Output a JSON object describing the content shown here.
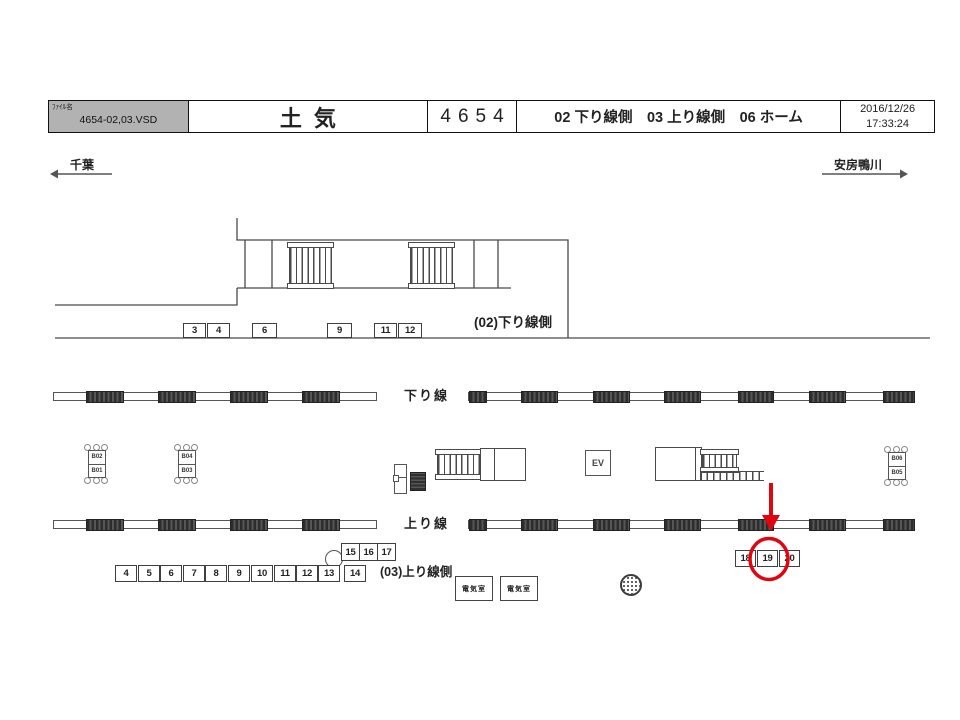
{
  "header": {
    "file_label": "ﾌｧｲﾙ名",
    "file_name": "4654-02,03.VSD",
    "station_name": "土気",
    "station_code": "4654",
    "sheet_refs": "02 下り線側　03 上り線側　06 ホーム",
    "date": "2016/12/26",
    "time": "17:33:24"
  },
  "directions": {
    "left": "千葉",
    "right": "安房鴨川"
  },
  "area_labels": {
    "down_side": "(02)下り線側",
    "up_side": "(03)上り線側"
  },
  "tracks": {
    "down_label": "下り線",
    "up_label": "上り線",
    "bands": [
      {
        "x": 53,
        "y": 392,
        "w": 324,
        "dark": [
          [
            32,
            38
          ],
          [
            104,
            38
          ],
          [
            176,
            38
          ],
          [
            248,
            38
          ]
        ]
      },
      {
        "x": 468,
        "y": 392,
        "w": 447,
        "dark": [
          [
            0,
            18
          ],
          [
            52,
            37
          ],
          [
            124,
            37
          ],
          [
            195,
            37
          ],
          [
            269,
            36
          ],
          [
            340,
            37
          ],
          [
            414,
            32
          ]
        ]
      },
      {
        "x": 53,
        "y": 520,
        "w": 324,
        "dark": [
          [
            32,
            38
          ],
          [
            104,
            38
          ],
          [
            176,
            38
          ],
          [
            248,
            38
          ]
        ]
      },
      {
        "x": 468,
        "y": 520,
        "w": 447,
        "dark": [
          [
            0,
            18
          ],
          [
            52,
            37
          ],
          [
            124,
            37
          ],
          [
            195,
            37
          ],
          [
            269,
            36
          ],
          [
            340,
            37
          ],
          [
            414,
            32
          ]
        ]
      }
    ]
  },
  "facilities": {
    "elevator": "EV",
    "electric_room": "電気室"
  },
  "benches": {
    "w": 24,
    "h": 34,
    "items": [
      {
        "top": "B02",
        "bottom": "B01",
        "x": 85,
        "y": 447
      },
      {
        "top": "B04",
        "bottom": "B03",
        "x": 175,
        "y": 447
      },
      {
        "top": "B06",
        "bottom": "B05",
        "x": 885,
        "y": 449
      }
    ]
  },
  "boards": {
    "down_side_row": {
      "y": 323,
      "h": 15,
      "items": [
        {
          "no": "3",
          "x": 183,
          "w": 23
        },
        {
          "no": "4",
          "x": 207,
          "w": 23
        },
        {
          "no": "6",
          "x": 252,
          "w": 25
        },
        {
          "no": "9",
          "x": 327,
          "w": 25
        },
        {
          "no": "11",
          "x": 374,
          "w": 23
        },
        {
          "no": "12",
          "x": 398,
          "w": 24
        }
      ]
    },
    "up_side_upper_row": {
      "y": 543,
      "h": 18,
      "items": [
        {
          "no": "15",
          "x": 341,
          "w": 19
        },
        {
          "no": "16",
          "x": 359,
          "w": 19
        },
        {
          "no": "17",
          "x": 377,
          "w": 19
        }
      ]
    },
    "up_side_lower_row": {
      "y": 565,
      "h": 17,
      "items": [
        {
          "no": "4",
          "x": 115,
          "w": 22
        },
        {
          "no": "5",
          "x": 138,
          "w": 22
        },
        {
          "no": "6",
          "x": 160,
          "w": 22
        },
        {
          "no": "7",
          "x": 183,
          "w": 22
        },
        {
          "no": "8",
          "x": 205,
          "w": 22
        },
        {
          "no": "9",
          "x": 228,
          "w": 22
        },
        {
          "no": "10",
          "x": 251,
          "w": 22
        },
        {
          "no": "11",
          "x": 274,
          "w": 22
        },
        {
          "no": "12",
          "x": 296,
          "w": 22
        },
        {
          "no": "13",
          "x": 318,
          "w": 22
        },
        {
          "no": "14",
          "x": 344,
          "w": 22
        }
      ]
    },
    "platform_row": {
      "y": 550,
      "h": 17,
      "items": [
        {
          "no": "18",
          "x": 735,
          "w": 21
        },
        {
          "no": "19",
          "x": 757,
          "w": 21
        },
        {
          "no": "20",
          "x": 779,
          "w": 21
        }
      ]
    }
  },
  "annotation": {
    "highlighted_board": "19"
  },
  "colors": {
    "accent_red": "#de0711",
    "header_gray": "#b2b2b2",
    "line": "#4a4a4a"
  }
}
